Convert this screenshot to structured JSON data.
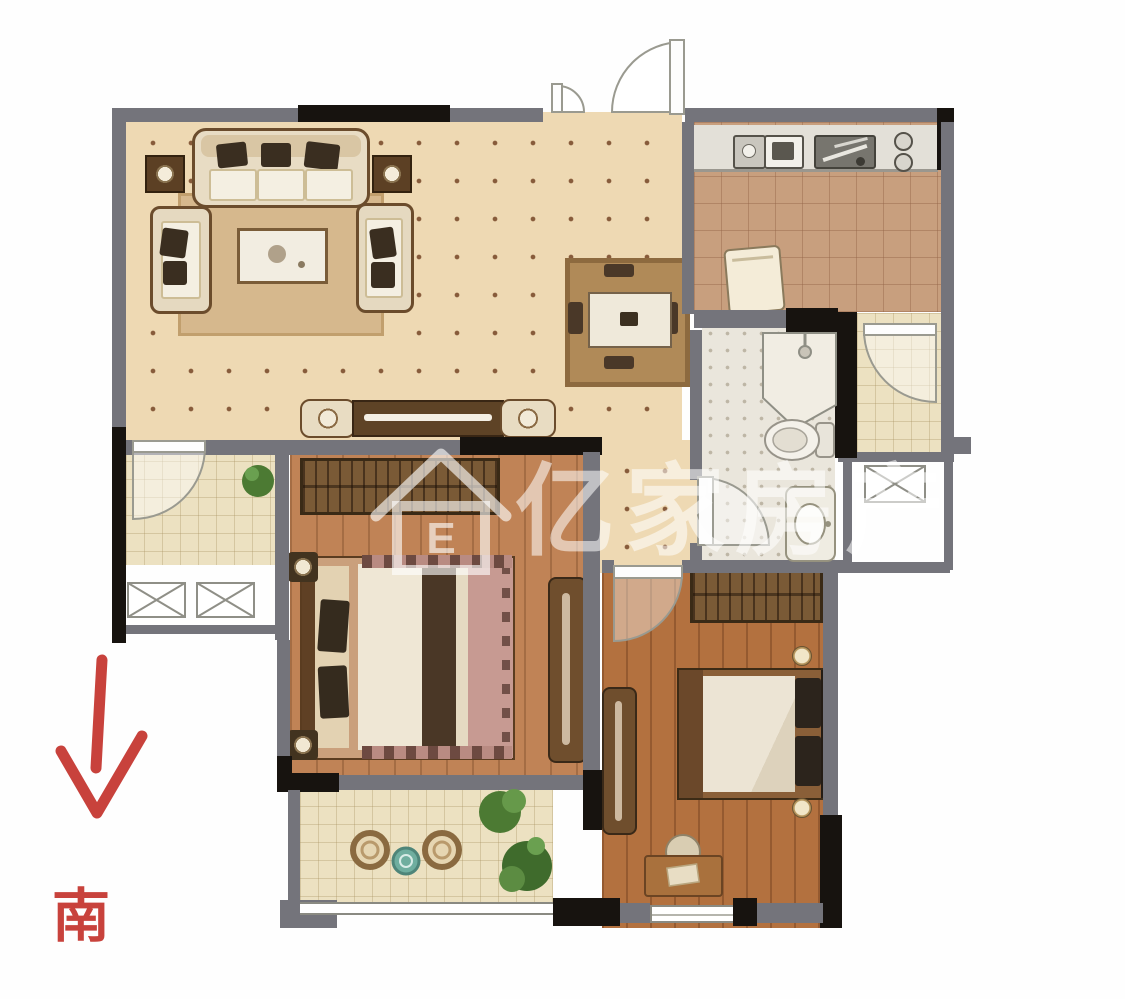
{
  "meta": {
    "type": "residential-floor-plan"
  },
  "watermark": {
    "logo_letter": "E",
    "brand_text": "亿家房产"
  },
  "compass": {
    "south_label": "南",
    "direction": "south"
  },
  "palette": {
    "background": "#ffffff",
    "wall_gray": "#74747b",
    "wall_black": "#17130f",
    "living_floor": "#eed9b3",
    "kitchen_floor": "#c89f7e",
    "bathroom_floor": "#eae6dc",
    "balcony_floor": "#ece1c1",
    "bedroom1_floor": "#c08356",
    "bedroom2_floor": "#b3713f",
    "accent_red": "#c8423c",
    "watermark_color": "rgba(255,255,255,0.55)"
  },
  "icons": {
    "watermark_logo": "house-outline-icon",
    "compass_arrow": "south-arrow-icon"
  }
}
